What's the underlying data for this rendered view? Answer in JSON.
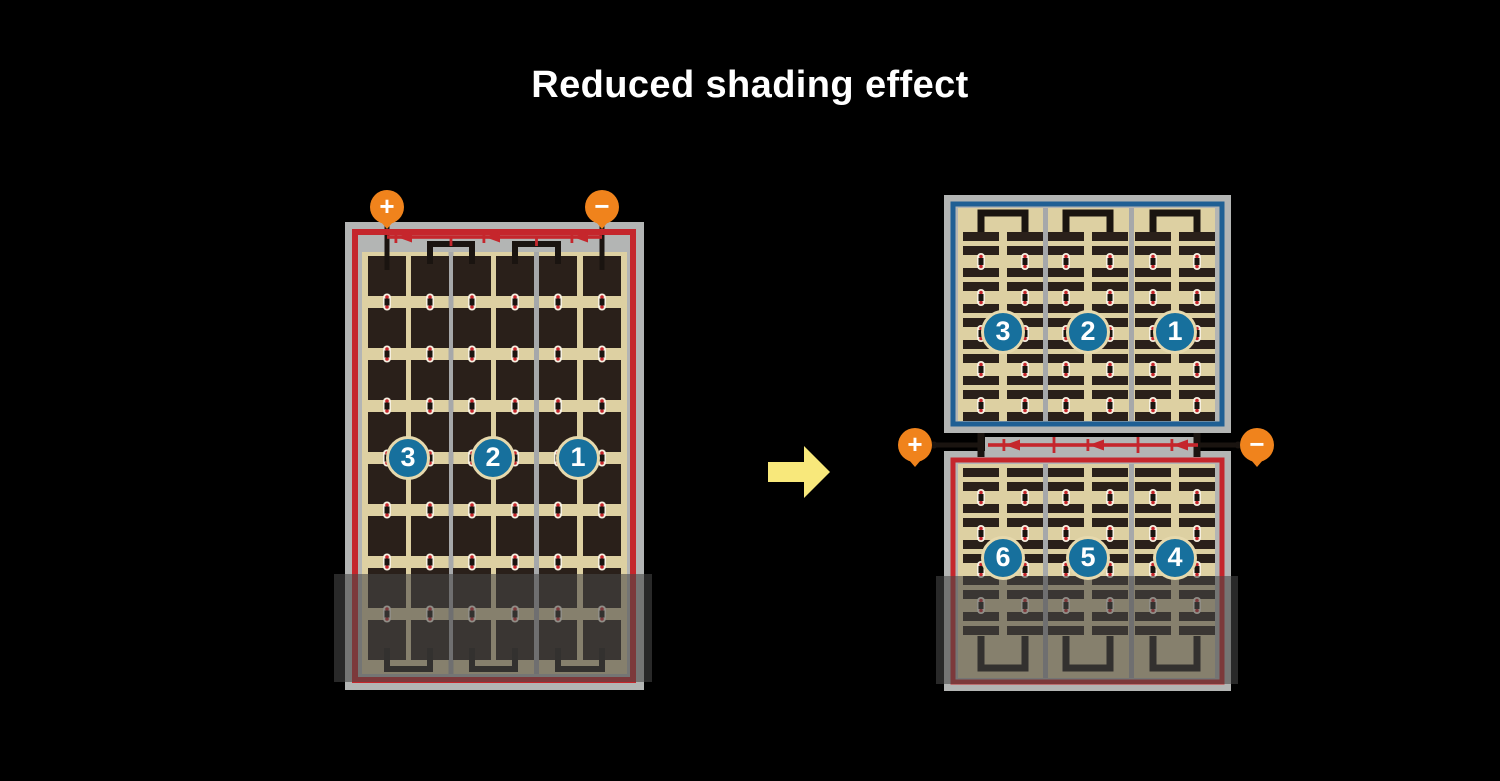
{
  "title": {
    "text": "Reduced shading effect"
  },
  "left_panel": {
    "terminals": {
      "plus": "+",
      "minus": "−"
    },
    "string_labels": [
      "3",
      "2",
      "1"
    ]
  },
  "right_panel": {
    "terminals": {
      "plus": "+",
      "minus": "−"
    },
    "top_string_labels": [
      "3",
      "2",
      "1"
    ],
    "bottom_string_labels": [
      "6",
      "5",
      "4"
    ]
  },
  "colors": {
    "background": "#000000",
    "title_text": "#ffffff",
    "panel_frame_gray": "#b3b5b4",
    "panel_divider_gray": "#a6a8aa",
    "cell_tan": "#ddd0a2",
    "cell_dark": "#2a201a",
    "circuit_red": "#c5262c",
    "circuit_blue": "#1f5f94",
    "badge_blue": "#17709d",
    "badge_ring_cream": "#e6d9ad",
    "terminal_orange": "#f0831c",
    "wire_black": "#1a1410",
    "arrow_yellow": "#f8e87b",
    "connector_white": "#f6f0e1",
    "connector_dot_red": "#c5262c",
    "shade_overlay": "rgba(70,70,70,0.58)"
  }
}
